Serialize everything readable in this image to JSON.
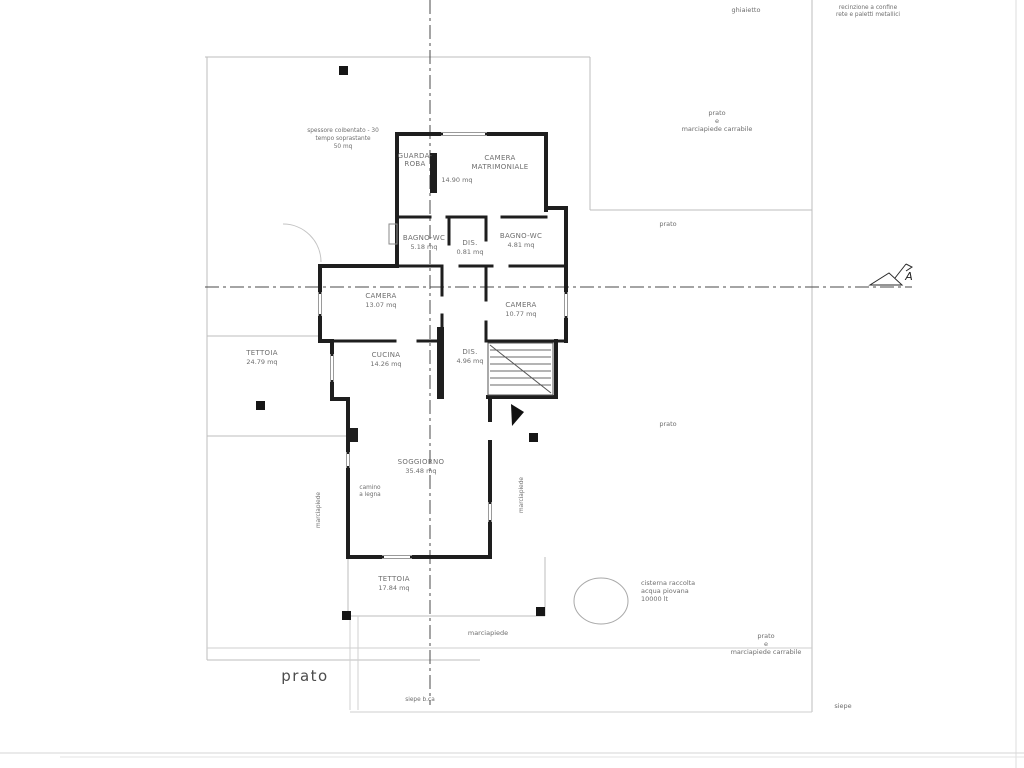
{
  "document": {
    "type": "scanned floor plan, ground floor, single-family house"
  },
  "rooms": {
    "guardaroba": {
      "name_line1": "GUARDA-",
      "name_line2": "ROBA"
    },
    "camera_matrimoniale": {
      "name_line1": "CAMERA",
      "name_line2": "MATRIMONIALE",
      "area": "14.90 mq"
    },
    "bagno_wc_sx": {
      "name": "BAGNO-WC",
      "area": "5.18 mq"
    },
    "dis_notte": {
      "name": "DIS.",
      "area": "0.81 mq"
    },
    "bagno_wc_dx": {
      "name": "BAGNO-WC",
      "area": "4.81 mq"
    },
    "camera_sx": {
      "name": "CAMERA",
      "area": "13.07 mq"
    },
    "camera_dx": {
      "name": "CAMERA",
      "area": "10.77 mq"
    },
    "cucina": {
      "name": "CUCINA",
      "area": "14.26 mq"
    },
    "dis_giorno": {
      "name": "DIS.",
      "area": "4.96 mq"
    },
    "soggiorno": {
      "name": "SOGGIORNO",
      "area": "35.48 mq"
    },
    "tettoia_ovest": {
      "name": "TETTOIA",
      "area": "24.79 mq"
    },
    "tettoia_sud": {
      "name": "TETTOIA",
      "area": "17.84 mq"
    }
  },
  "notes": {
    "top_left": [
      "spessore coibentato - 30",
      "tempo soprastante",
      "50 mq"
    ],
    "camino_line1": "camino",
    "camino_line2": "a legna",
    "cisterna": [
      "cisterna raccolta",
      "acqua piovana",
      "10000 lt"
    ]
  },
  "site": {
    "ghiaietto": "ghiaietto",
    "fence_line1": "recinzione a confine",
    "fence_line2": "rete e paletti metallici",
    "prato_marciapiede_1": "prato",
    "prato_marciapiede_2": "e",
    "prato_marciapiede_3": "marciapiede carrabile",
    "prato": "prato",
    "prato_big": "prato",
    "marciapiede": "marciapiede",
    "siepe": "siepe",
    "siepe_bassa": "siepe b.ca"
  },
  "section_marker": {
    "letter": "A"
  },
  "colors": {
    "wall": "#1e1e1e",
    "site_line": "#bdbdbd",
    "centerline": "#4a4a4a",
    "pencil_text": "#6e6e6e",
    "paper": "#ffffff"
  }
}
